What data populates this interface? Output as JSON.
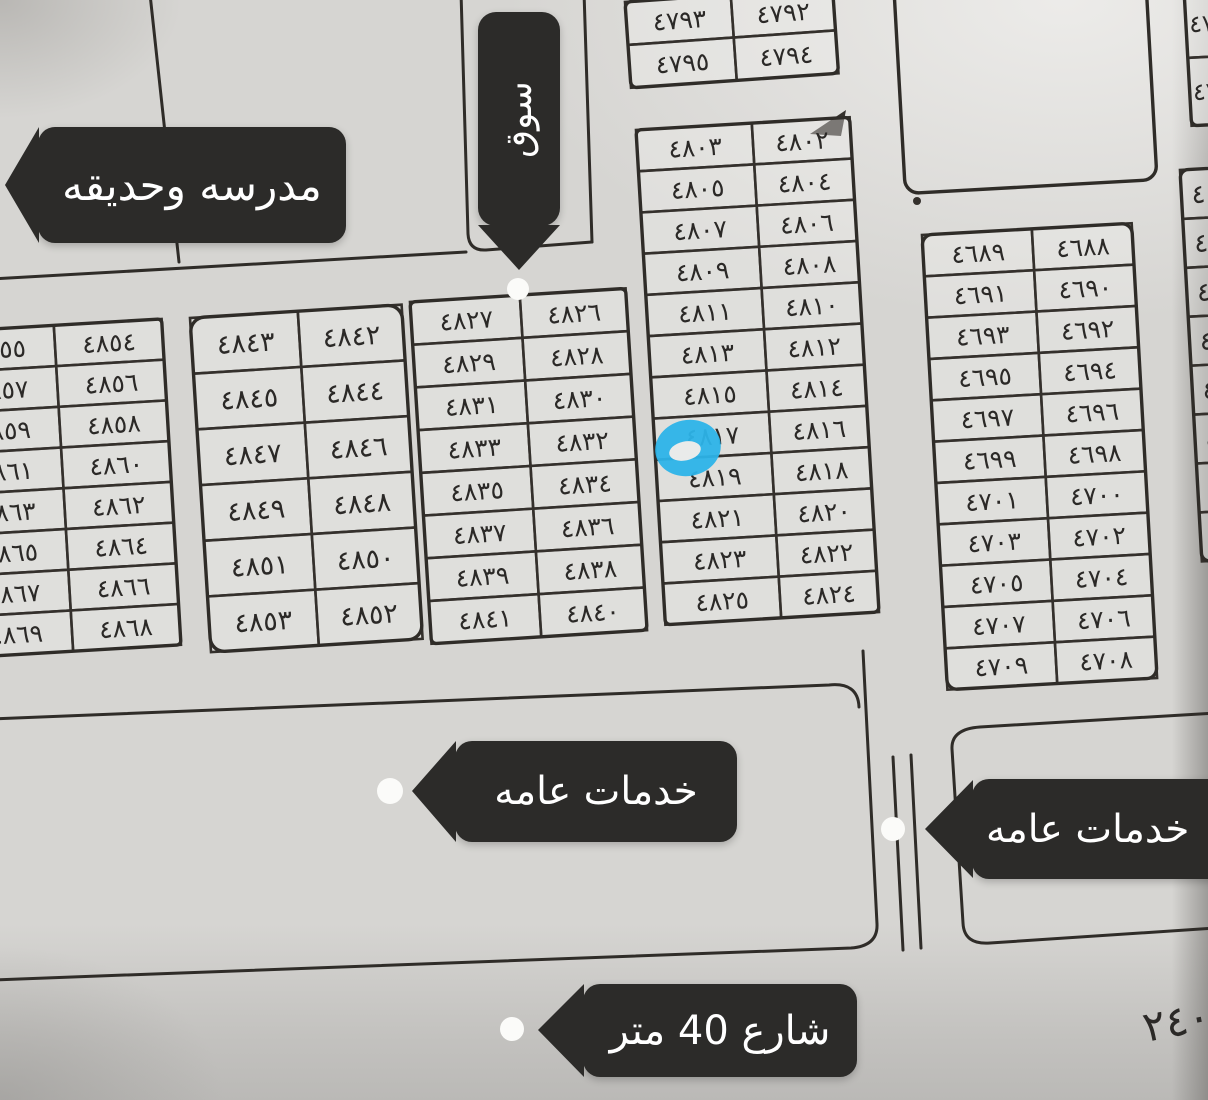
{
  "labels": {
    "school_garden": "مدرسه وحديقه",
    "market": "سوق",
    "services_left": "خدمات عامه",
    "services_right": "خدمات عامه",
    "street_40m": "شارع 40 متر",
    "corner_note": "٢٤٠"
  },
  "highlight": {
    "plot": "٤٨١٧",
    "color": "#2cb3e8"
  },
  "colors": {
    "ink": "#34302c",
    "paper": "#d6d5d2",
    "callout_bg": "#2c2b29",
    "callout_text": "#ffffff",
    "dot": "#fbfbf9"
  },
  "empty_box": {
    "x": 892,
    "y": -46,
    "w": 252,
    "h": 240,
    "rot": -3.2
  },
  "blocks": [
    {
      "id": "block-north-pair",
      "x": 625,
      "y": 2,
      "rot": -4,
      "cols": [
        106,
        102
      ],
      "row_h": 43,
      "font": 25,
      "rx": 6,
      "rows": [
        [
          "٤٧٩٣",
          "٤٧٩٢"
        ],
        [
          "٤٧٩٥",
          "٤٧٩٤"
        ]
      ]
    },
    {
      "id": "block-4802-4825",
      "x": 636,
      "y": 130,
      "rot": -3.4,
      "cols": [
        116,
        98
      ],
      "row_h": 41.3,
      "font": 25,
      "rx": 5,
      "rows": [
        [
          "٤٨٠٣",
          "٤٨٠٢"
        ],
        [
          "٤٨٠٥",
          "٤٨٠٤"
        ],
        [
          "٤٨٠٧",
          "٤٨٠٦"
        ],
        [
          "٤٨٠٩",
          "٤٨٠٨"
        ],
        [
          "٤٨١١",
          "٤٨١٠"
        ],
        [
          "٤٨١٣",
          "٤٨١٢"
        ],
        [
          "٤٨١٥",
          "٤٨١٤"
        ],
        [
          "٤٨١٧",
          "٤٨١٦"
        ],
        [
          "٤٨١٩",
          "٤٨١٨"
        ],
        [
          "٤٨٢١",
          "٤٨٢٠"
        ],
        [
          "٤٨٢٣",
          "٤٨٢٢"
        ],
        [
          "٤٨٢٥",
          "٤٨٢٤"
        ]
      ]
    },
    {
      "id": "block-4826-4841",
      "x": 410,
      "y": 302,
      "rot": -3.6,
      "cols": [
        110,
        106
      ],
      "row_h": 42.8,
      "font": 25,
      "rx": 5,
      "rows": [
        [
          "٤٨٢٧",
          "٤٨٢٦"
        ],
        [
          "٤٨٢٩",
          "٤٨٢٨"
        ],
        [
          "٤٨٣١",
          "٤٨٣٠"
        ],
        [
          "٤٨٣٣",
          "٤٨٣٢"
        ],
        [
          "٤٨٣٥",
          "٤٨٣٤"
        ],
        [
          "٤٨٣٧",
          "٤٨٣٦"
        ],
        [
          "٤٨٣٩",
          "٤٨٣٨"
        ],
        [
          "٤٨٤١",
          "٤٨٤٠"
        ]
      ]
    },
    {
      "id": "block-4842-4853",
      "x": 190,
      "y": 318,
      "rot": -3.6,
      "cols": [
        108,
        104
      ],
      "row_h": 55.8,
      "font": 27,
      "rx": 14,
      "rows": [
        [
          "٤٨٤٣",
          "٤٨٤٢"
        ],
        [
          "٤٨٤٥",
          "٤٨٤٤"
        ],
        [
          "٤٨٤٧",
          "٤٨٤٦"
        ],
        [
          "٤٨٤٩",
          "٤٨٤٨"
        ],
        [
          "٤٨٥١",
          "٤٨٥٠"
        ],
        [
          "٤٨٥٣",
          "٤٨٥٢"
        ]
      ]
    },
    {
      "id": "block-4854-4869",
      "x": -58,
      "y": 332,
      "rot": -3.4,
      "cols": [
        112,
        108
      ],
      "row_h": 40.8,
      "font": 25,
      "rx": 4,
      "rows": [
        [
          "٤٨٥٥",
          "٤٨٥٤"
        ],
        [
          "٤٨٥٧",
          "٤٨٥٦"
        ],
        [
          "٤٨٥٩",
          "٤٨٥٨"
        ],
        [
          "٤٨٦١",
          "٤٨٦٠"
        ],
        [
          "٤٨٦٣",
          "٤٨٦٢"
        ],
        [
          "٤٨٦٥",
          "٤٨٦٤"
        ],
        [
          "٤٨٦٧",
          "٤٨٦٦"
        ],
        [
          "٤٨٦٩",
          "٤٨٦٨"
        ]
      ]
    },
    {
      "id": "block-4688-4709",
      "x": 922,
      "y": 235,
      "rot": -3.2,
      "cols": [
        110,
        100
      ],
      "row_h": 41.4,
      "font": 25,
      "rx": 10,
      "rows": [
        [
          "٤٦٨٩",
          "٤٦٨٨"
        ],
        [
          "٤٦٩١",
          "٤٦٩٠"
        ],
        [
          "٤٦٩٣",
          "٤٦٩٢"
        ],
        [
          "٤٦٩٥",
          "٤٦٩٤"
        ],
        [
          "٤٦٩٧",
          "٤٦٩٦"
        ],
        [
          "٤٦٩٩",
          "٤٦٩٨"
        ],
        [
          "٤٧٠١",
          "٤٧٠٠"
        ],
        [
          "٤٧٠٣",
          "٤٧٠٢"
        ],
        [
          "٤٧٠٥",
          "٤٧٠٤"
        ],
        [
          "٤٧٠٧",
          "٤٧٠٦"
        ],
        [
          "٤٧٠٩",
          "٤٧٠٨"
        ]
      ]
    },
    {
      "id": "block-east-edge",
      "x": 1180,
      "y": 170,
      "rot": -3.2,
      "cols": [
        110
      ],
      "row_h": 49,
      "font": 26,
      "tx": -38,
      "rx": 8,
      "rows": [
        [
          "٤"
        ],
        [
          "٤"
        ],
        [
          "٤"
        ],
        [
          "٤"
        ],
        [
          "٤"
        ],
        [
          "٤"
        ],
        [
          "٤"
        ],
        [
          "٤"
        ]
      ]
    },
    {
      "id": "block-northeast-edge",
      "x": 1184,
      "y": -10,
      "rot": -3.2,
      "cols": [
        100
      ],
      "row_h": 68,
      "font": 24,
      "tx": -34,
      "rx": 6,
      "rows": [
        [
          "٤٧"
        ],
        [
          "٤٧"
        ]
      ]
    }
  ]
}
